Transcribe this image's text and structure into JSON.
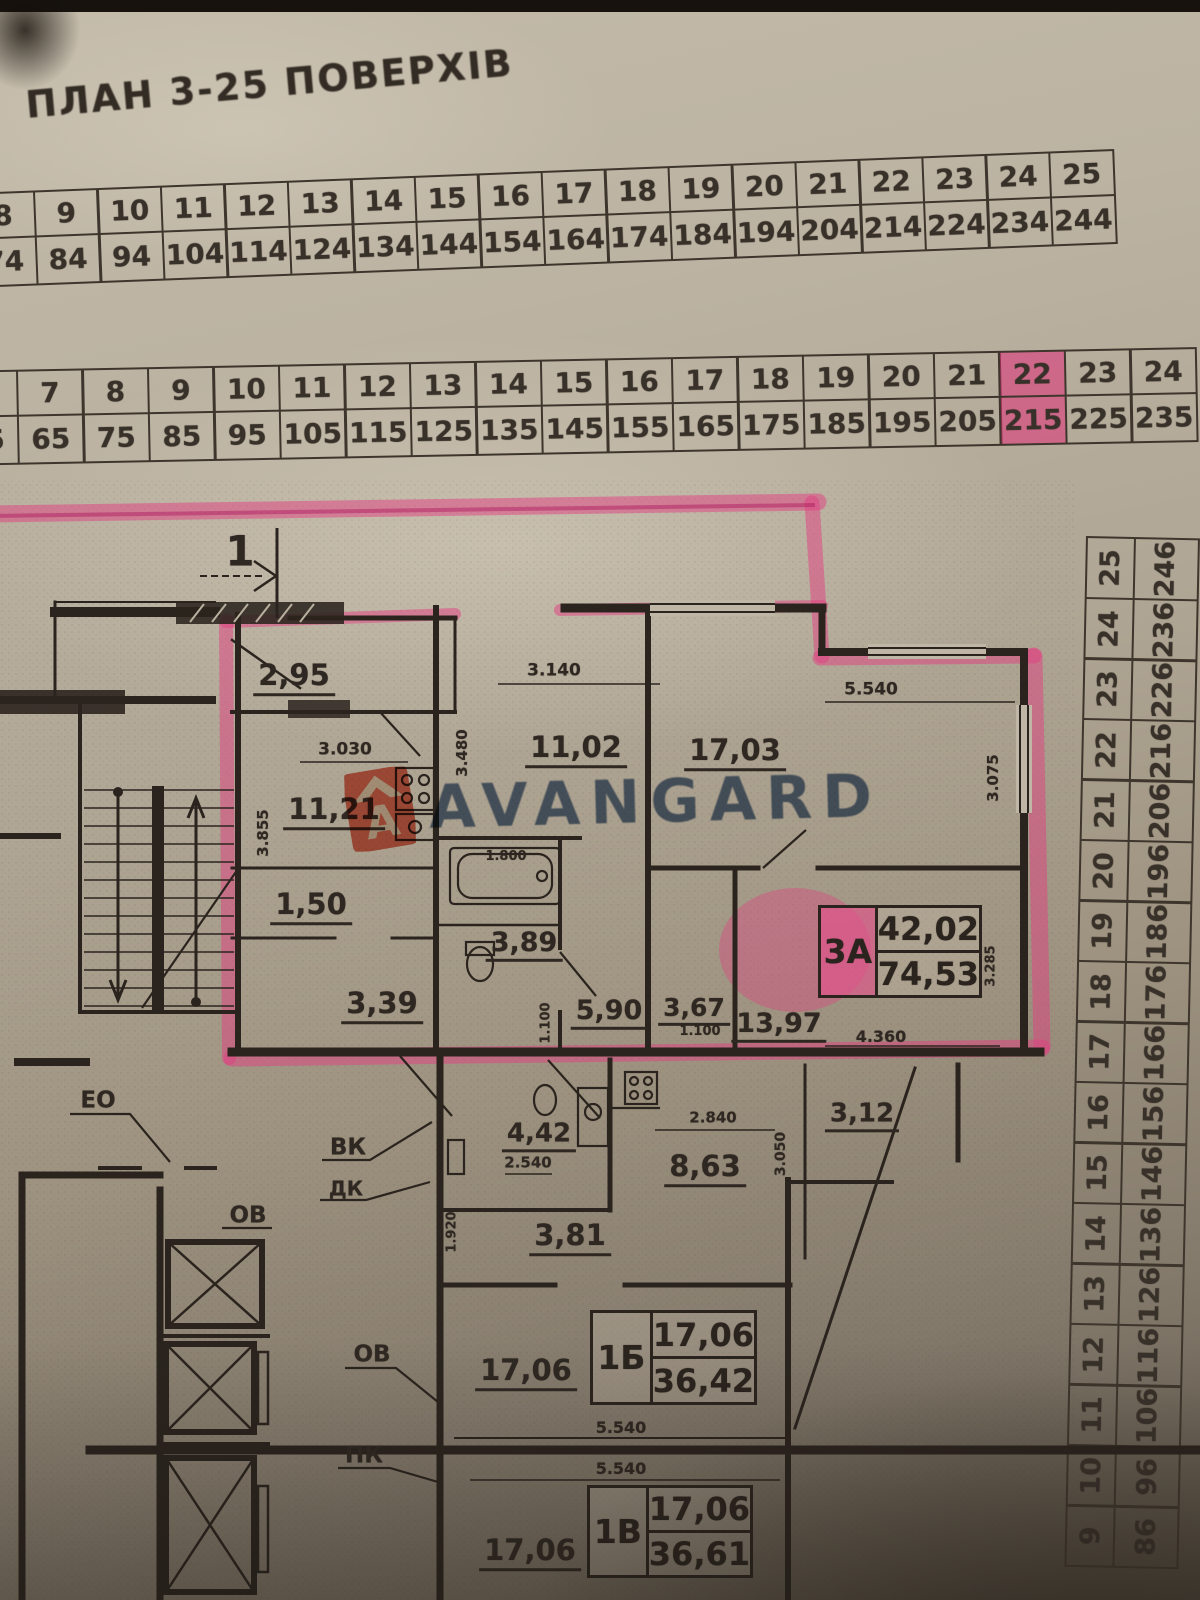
{
  "title": "ПЛАН 3-25 ПОВЕРХІВ",
  "table_top": {
    "cols": [
      {
        "f": "8",
        "a": "74"
      },
      {
        "f": "9",
        "a": "84"
      },
      {
        "f": "10",
        "a": "94"
      },
      {
        "f": "11",
        "a": "104"
      },
      {
        "f": "12",
        "a": "114"
      },
      {
        "f": "13",
        "a": "124"
      },
      {
        "f": "14",
        "a": "134"
      },
      {
        "f": "15",
        "a": "144"
      },
      {
        "f": "16",
        "a": "154"
      },
      {
        "f": "17",
        "a": "164"
      },
      {
        "f": "18",
        "a": "174"
      },
      {
        "f": "19",
        "a": "184"
      },
      {
        "f": "20",
        "a": "194"
      },
      {
        "f": "21",
        "a": "204"
      },
      {
        "f": "22",
        "a": "214"
      },
      {
        "f": "23",
        "a": "224"
      },
      {
        "f": "24",
        "a": "234"
      },
      {
        "f": "25",
        "a": "244"
      }
    ]
  },
  "table_mid": {
    "cols": [
      {
        "f": "6",
        "a": "55"
      },
      {
        "f": "7",
        "a": "65"
      },
      {
        "f": "8",
        "a": "75"
      },
      {
        "f": "9",
        "a": "85"
      },
      {
        "f": "10",
        "a": "95"
      },
      {
        "f": "11",
        "a": "105"
      },
      {
        "f": "12",
        "a": "115"
      },
      {
        "f": "13",
        "a": "125"
      },
      {
        "f": "14",
        "a": "135"
      },
      {
        "f": "15",
        "a": "145"
      },
      {
        "f": "16",
        "a": "155"
      },
      {
        "f": "17",
        "a": "165"
      },
      {
        "f": "18",
        "a": "175"
      },
      {
        "f": "19",
        "a": "185"
      },
      {
        "f": "20",
        "a": "195"
      },
      {
        "f": "21",
        "a": "205"
      },
      {
        "f": "22",
        "a": "215"
      },
      {
        "f": "23",
        "a": "225"
      },
      {
        "f": "24",
        "a": "235"
      }
    ],
    "highlighted_floor": "22",
    "highlighted_apartment": "215"
  },
  "table_right": {
    "rows": [
      {
        "f": "25",
        "a": "246"
      },
      {
        "f": "24",
        "a": "236"
      },
      {
        "f": "23",
        "a": "226"
      },
      {
        "f": "22",
        "a": "216"
      },
      {
        "f": "21",
        "a": "206"
      },
      {
        "f": "20",
        "a": "196"
      },
      {
        "f": "19",
        "a": "186"
      },
      {
        "f": "18",
        "a": "176"
      },
      {
        "f": "17",
        "a": "166"
      },
      {
        "f": "16",
        "a": "156"
      },
      {
        "f": "15",
        "a": "146"
      },
      {
        "f": "14",
        "a": "136"
      },
      {
        "f": "13",
        "a": "126"
      },
      {
        "f": "12",
        "a": "116"
      },
      {
        "f": "11",
        "a": "106"
      },
      {
        "f": "10",
        "a": "96"
      },
      {
        "f": "9",
        "a": "86"
      }
    ]
  },
  "watermark": {
    "text": "AVANGARD",
    "logo_letter": "A"
  },
  "plan": {
    "section_marker": "1",
    "areas": {
      "balcony": "2,95",
      "room_a": "11,21",
      "hall_a": "1,50",
      "corridor_a": "3,39",
      "bath_a": "3,89",
      "kitchen_a": "11,02",
      "room_b": "17,03",
      "corridor_b": "5,90",
      "corridor_c": "3,67",
      "room_c": "13,97",
      "bath_b": "4,42",
      "kitchen_b": "8,63",
      "hall_b": "3,81",
      "balcony_b": "3,12",
      "room_d": "17,06",
      "room_e": "17,06"
    },
    "dims": {
      "d3140": "3.140",
      "d3030": "3.030",
      "d3480": "3.480",
      "d3855": "3.855",
      "d1800": "1.800",
      "d5540_top": "5.540",
      "d3075": "3.075",
      "d3285": "3.285",
      "d1100a": "1.100",
      "d1100b": "1.100",
      "d4360": "4.360",
      "d2840": "2.840",
      "d2540": "2.540",
      "d3050": "3.050",
      "d1920": "1.920",
      "d5540_mid": "5.540",
      "d5540_bot": "5.540"
    },
    "eng_labels": {
      "eo": "ЕО",
      "ov_top": "ОВ",
      "vk": "ВК",
      "dk": "ДК",
      "ov_bottom": "ОВ",
      "pk": "ПК"
    },
    "apartments": [
      {
        "code": "3А",
        "room_area": "42,02",
        "total_area": "74,53"
      },
      {
        "code": "1Б",
        "room_area": "17,06",
        "total_area": "36,42"
      },
      {
        "code": "1В",
        "room_area": "17,06",
        "total_area": "36,61"
      }
    ]
  },
  "colors": {
    "highlighter": "#e23f82",
    "ink": "#2b241e",
    "paper": "#b8afa0",
    "watermark_text": "#48638a",
    "logo": "#d84a31"
  }
}
